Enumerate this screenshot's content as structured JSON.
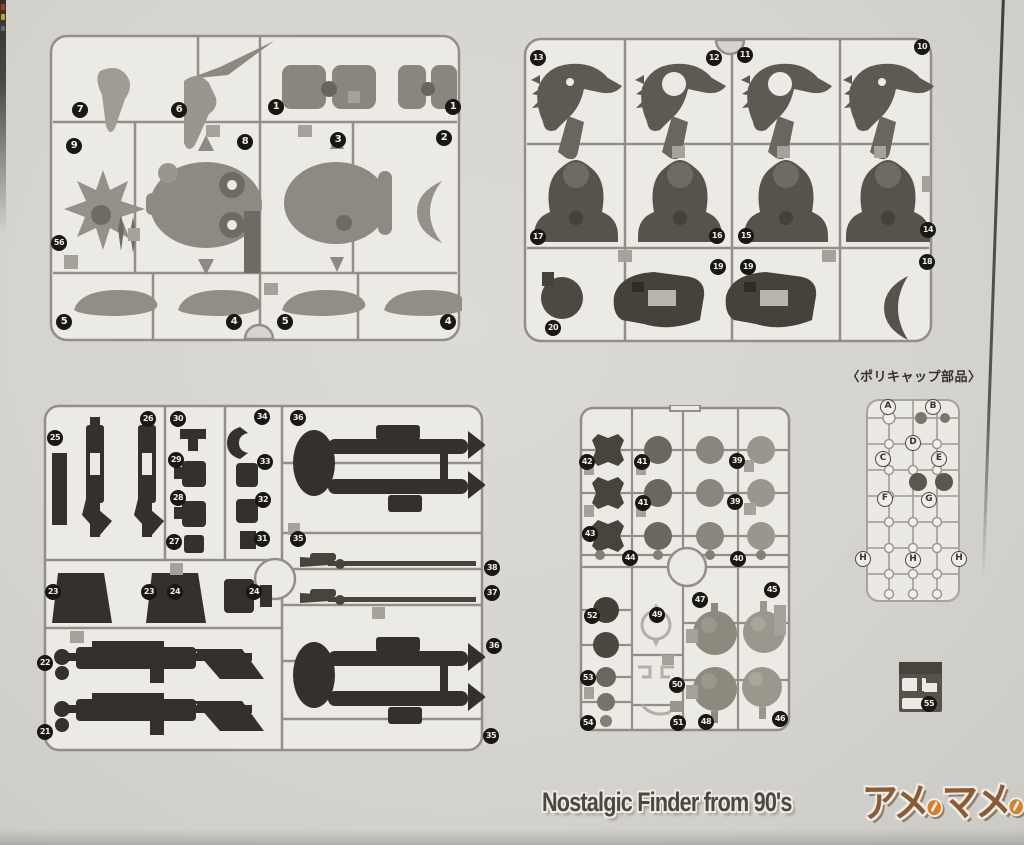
{
  "page": {
    "paper_color": "#d6d4cf",
    "runner_line_color": "#928f89",
    "badge_color": "#191711",
    "badge_text_color": "#f0ede7"
  },
  "polycap": {
    "title": "〈ポリキャップ部品〉",
    "letters": [
      {
        "label": "A",
        "x": 888,
        "y": 407
      },
      {
        "label": "B",
        "x": 933,
        "y": 407
      },
      {
        "label": "D",
        "x": 913,
        "y": 443
      },
      {
        "label": "C",
        "x": 883,
        "y": 459
      },
      {
        "label": "E",
        "x": 939,
        "y": 459
      },
      {
        "label": "F",
        "x": 885,
        "y": 499
      },
      {
        "label": "G",
        "x": 929,
        "y": 500
      },
      {
        "label": "H",
        "x": 863,
        "y": 559
      },
      {
        "label": "H",
        "x": 913,
        "y": 560
      },
      {
        "label": "H",
        "x": 959,
        "y": 559
      }
    ]
  },
  "runners": [
    {
      "id": "runner-top-left",
      "badges": [
        {
          "label": "7",
          "x": 80,
          "y": 110
        },
        {
          "label": "6",
          "x": 179,
          "y": 110
        },
        {
          "label": "1",
          "x": 276,
          "y": 107
        },
        {
          "label": "1",
          "x": 453,
          "y": 107
        },
        {
          "label": "9",
          "x": 74,
          "y": 146
        },
        {
          "label": "8",
          "x": 245,
          "y": 142
        },
        {
          "label": "3",
          "x": 338,
          "y": 140
        },
        {
          "label": "2",
          "x": 444,
          "y": 138
        },
        {
          "label": "56",
          "x": 59,
          "y": 243
        },
        {
          "label": "5",
          "x": 64,
          "y": 322
        },
        {
          "label": "4",
          "x": 234,
          "y": 322
        },
        {
          "label": "5",
          "x": 285,
          "y": 322
        },
        {
          "label": "4",
          "x": 448,
          "y": 322
        }
      ]
    },
    {
      "id": "runner-top-right",
      "badges": [
        {
          "label": "13",
          "x": 538,
          "y": 58
        },
        {
          "label": "12",
          "x": 714,
          "y": 58
        },
        {
          "label": "11",
          "x": 745,
          "y": 55
        },
        {
          "label": "10",
          "x": 922,
          "y": 47
        },
        {
          "label": "17",
          "x": 538,
          "y": 237
        },
        {
          "label": "16",
          "x": 717,
          "y": 236
        },
        {
          "label": "15",
          "x": 746,
          "y": 236
        },
        {
          "label": "14",
          "x": 928,
          "y": 230
        },
        {
          "label": "19",
          "x": 718,
          "y": 267
        },
        {
          "label": "19",
          "x": 748,
          "y": 267
        },
        {
          "label": "18",
          "x": 927,
          "y": 262
        },
        {
          "label": "20",
          "x": 553,
          "y": 328
        }
      ]
    },
    {
      "id": "runner-bottom-left",
      "badges": [
        {
          "label": "25",
          "x": 55,
          "y": 438
        },
        {
          "label": "26",
          "x": 148,
          "y": 419
        },
        {
          "label": "30",
          "x": 178,
          "y": 419
        },
        {
          "label": "34",
          "x": 262,
          "y": 417
        },
        {
          "label": "29",
          "x": 176,
          "y": 460
        },
        {
          "label": "33",
          "x": 265,
          "y": 462
        },
        {
          "label": "28",
          "x": 178,
          "y": 498
        },
        {
          "label": "32",
          "x": 263,
          "y": 500
        },
        {
          "label": "27",
          "x": 174,
          "y": 542
        },
        {
          "label": "31",
          "x": 262,
          "y": 539
        },
        {
          "label": "23",
          "x": 53,
          "y": 592
        },
        {
          "label": "23",
          "x": 149,
          "y": 592
        },
        {
          "label": "24",
          "x": 175,
          "y": 592
        },
        {
          "label": "24",
          "x": 254,
          "y": 592
        },
        {
          "label": "22",
          "x": 45,
          "y": 663
        },
        {
          "label": "21",
          "x": 45,
          "y": 732
        },
        {
          "label": "36",
          "x": 298,
          "y": 418
        },
        {
          "label": "35",
          "x": 298,
          "y": 539
        },
        {
          "label": "38",
          "x": 492,
          "y": 568
        },
        {
          "label": "37",
          "x": 492,
          "y": 593
        },
        {
          "label": "36",
          "x": 494,
          "y": 646
        },
        {
          "label": "35",
          "x": 491,
          "y": 736
        }
      ]
    },
    {
      "id": "runner-bottom-middle",
      "badges": [
        {
          "label": "42",
          "x": 587,
          "y": 462
        },
        {
          "label": "41",
          "x": 642,
          "y": 462
        },
        {
          "label": "39",
          "x": 737,
          "y": 461
        },
        {
          "label": "41",
          "x": 643,
          "y": 503
        },
        {
          "label": "39",
          "x": 735,
          "y": 502
        },
        {
          "label": "43",
          "x": 590,
          "y": 534
        },
        {
          "label": "44",
          "x": 630,
          "y": 558
        },
        {
          "label": "40",
          "x": 738,
          "y": 559
        },
        {
          "label": "47",
          "x": 700,
          "y": 600
        },
        {
          "label": "45",
          "x": 772,
          "y": 590
        },
        {
          "label": "52",
          "x": 592,
          "y": 616
        },
        {
          "label": "49",
          "x": 657,
          "y": 615
        },
        {
          "label": "53",
          "x": 588,
          "y": 678
        },
        {
          "label": "50",
          "x": 677,
          "y": 685
        },
        {
          "label": "54",
          "x": 588,
          "y": 723
        },
        {
          "label": "51",
          "x": 678,
          "y": 723
        },
        {
          "label": "48",
          "x": 706,
          "y": 722
        },
        {
          "label": "46",
          "x": 780,
          "y": 719
        }
      ]
    },
    {
      "id": "runner-part-55",
      "badges": [
        {
          "label": "55",
          "x": 929,
          "y": 704
        }
      ]
    }
  ],
  "watermark": {
    "text": "Nostalgic Finder from 90's",
    "logo_text": "アメのマメのバー",
    "logo_segments": [
      "アメ",
      "マメ",
      "バー"
    ],
    "text_color": "#4b4742",
    "logo_color": "#8b5b38",
    "bean_color": "#d3802f"
  }
}
